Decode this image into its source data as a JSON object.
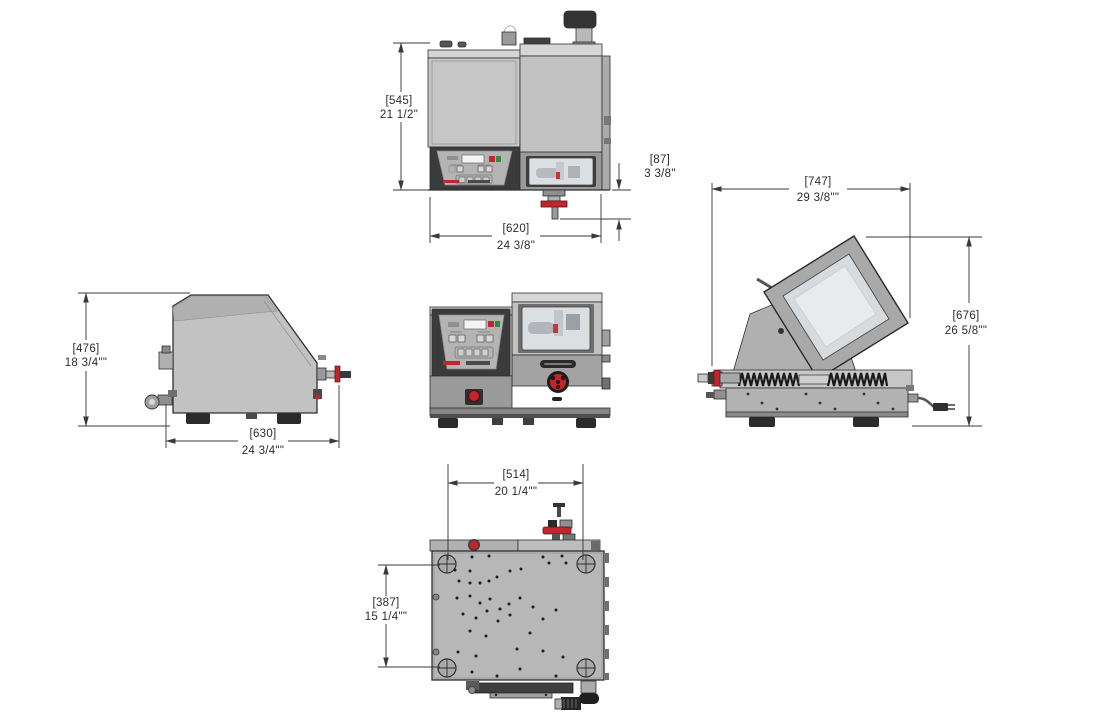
{
  "colors": {
    "background": "#ffffff",
    "outline": "#2f2f2f",
    "dimension_line": "#3a3a3a",
    "dimension_text": "#2c2c2c",
    "body_gray": "#c2c2c2",
    "cap_gray": "#d5d5d5",
    "base_gray": "#9a9a9a",
    "panel_dark": "#3b3b3b",
    "panel_face": "#b4b4b4",
    "window_glass": "#dcdfe2",
    "accent_red": "#c0262c",
    "accent_green": "#2e8b3d",
    "feet_dark": "#2b2b2b"
  },
  "views": {
    "front_elevation": {
      "dim_height": {
        "mm": "[545]",
        "in": "21 1/2\""
      },
      "dim_drain": {
        "mm": "[87]",
        "in": "3 3/8\""
      },
      "dim_width": {
        "mm": "[620]",
        "in": "24 3/8\""
      }
    },
    "isometric_open": {
      "dim_depth": {
        "mm": "[747]",
        "in": "29 3/8\"\""
      },
      "dim_open_height": {
        "mm": "[676]",
        "in": "26 5/8\"\""
      }
    },
    "side_view": {
      "dim_height": {
        "mm": "[476]",
        "in": "18 3/4\"\""
      },
      "dim_depth": {
        "mm": "[630]",
        "in": "24 3/4\"\""
      }
    },
    "top_view": {
      "dim_width": {
        "mm": "[514]",
        "in": "20 1/4\"\""
      },
      "dim_depth": {
        "mm": "[387]",
        "in": "15 1/4\"\""
      }
    }
  }
}
